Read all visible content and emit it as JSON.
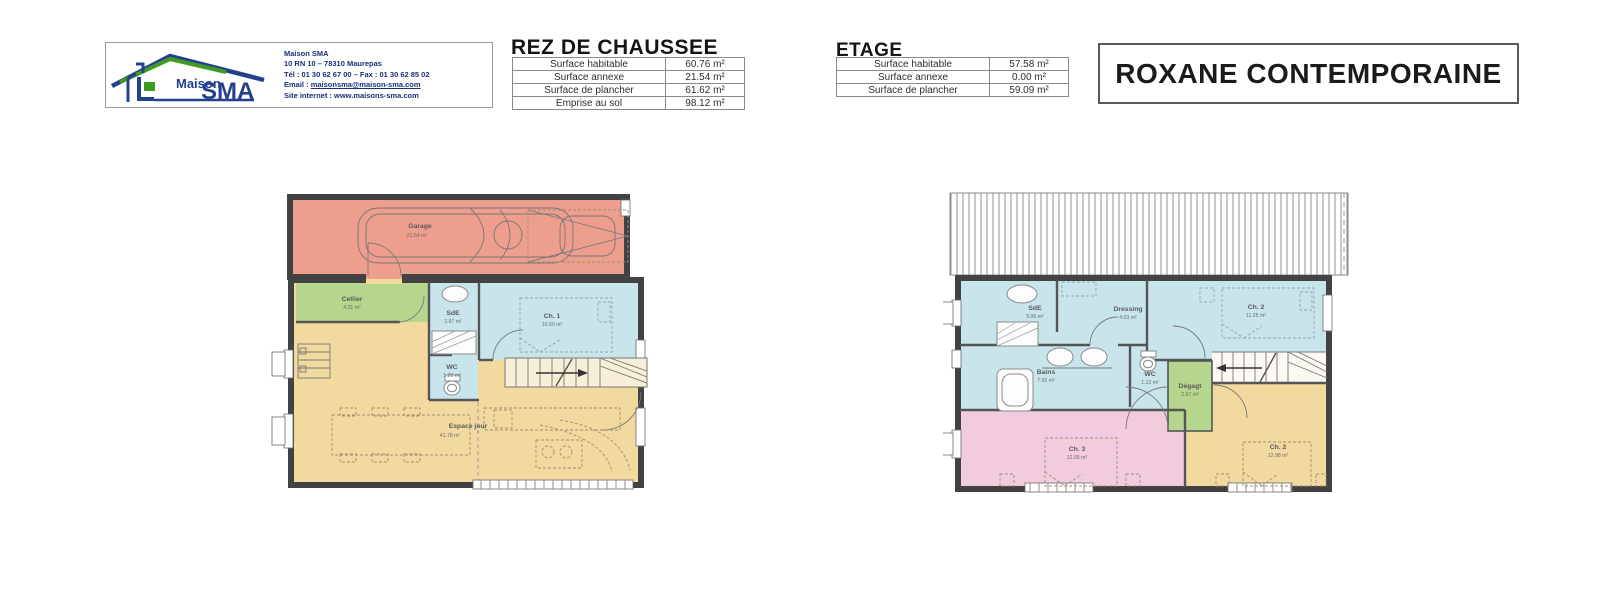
{
  "logo": {
    "brand_word": "Maison",
    "brand_main": "SMA",
    "company": "Maison SMA",
    "address": "10 RN 10 – 78310 Maurepas",
    "phone_fax": "Tél : 01 30 62 67 00 – Fax : 01 30 62 85 02",
    "email_label": "Email : ",
    "email": "maisonsma@maison-sma.com",
    "site_label": "Site internet : ",
    "site": "www.maisons-sma.com"
  },
  "rdc_table": {
    "title": "REZ DE CHAUSSEE",
    "rows": [
      {
        "label": "Surface habitable",
        "value": "60.76 m²"
      },
      {
        "label": "Surface annexe",
        "value": "21.54 m²"
      },
      {
        "label": "Surface de plancher",
        "value": "61.62 m²"
      },
      {
        "label": "Emprise au sol",
        "value": "98.12 m²"
      }
    ]
  },
  "etage_table": {
    "title": "ETAGE",
    "rows": [
      {
        "label": "Surface habitable",
        "value": "57.58 m²"
      },
      {
        "label": "Surface annexe",
        "value": "0.00 m²"
      },
      {
        "label": "Surface de plancher",
        "value": "59.09 m²"
      }
    ]
  },
  "model_title": "ROXANE CONTEMPORAINE",
  "rdc_plan": {
    "rooms": [
      {
        "name": "Garage",
        "area": "21.54 m²"
      },
      {
        "name": "Cellier",
        "area": "4.31 m²"
      },
      {
        "name": "SdE",
        "area": "2.97 m²"
      },
      {
        "name": "Ch. 1",
        "area": "10.50 m²"
      },
      {
        "name": "WC",
        "area": "1.20 m²"
      },
      {
        "name": "Espace jour",
        "area": "41.78 m²"
      }
    ]
  },
  "etage_plan": {
    "rooms": [
      {
        "name": "SdE",
        "area": "5.06 m²"
      },
      {
        "name": "Dressing",
        "area": "4.03 m²"
      },
      {
        "name": "Ch. 2",
        "area": "11.25 m²"
      },
      {
        "name": "Bains",
        "area": "7.92 m²"
      },
      {
        "name": "WC",
        "area": "1.12 m²"
      },
      {
        "name": "Dégagt",
        "area": "2.57 m²"
      },
      {
        "name": "Ch. 3",
        "area": "12.65 m²"
      },
      {
        "name": "Ch. 2",
        "area": "12.98 m²"
      }
    ]
  },
  "colors": {
    "garage": "#ed9e8d",
    "green": "#b5d68c",
    "blue": "#c7e5eb",
    "yellow": "#f1d9a0",
    "pink": "#f2cbde",
    "brand_blue": "#24418e",
    "brand_green": "#3f9b23"
  }
}
